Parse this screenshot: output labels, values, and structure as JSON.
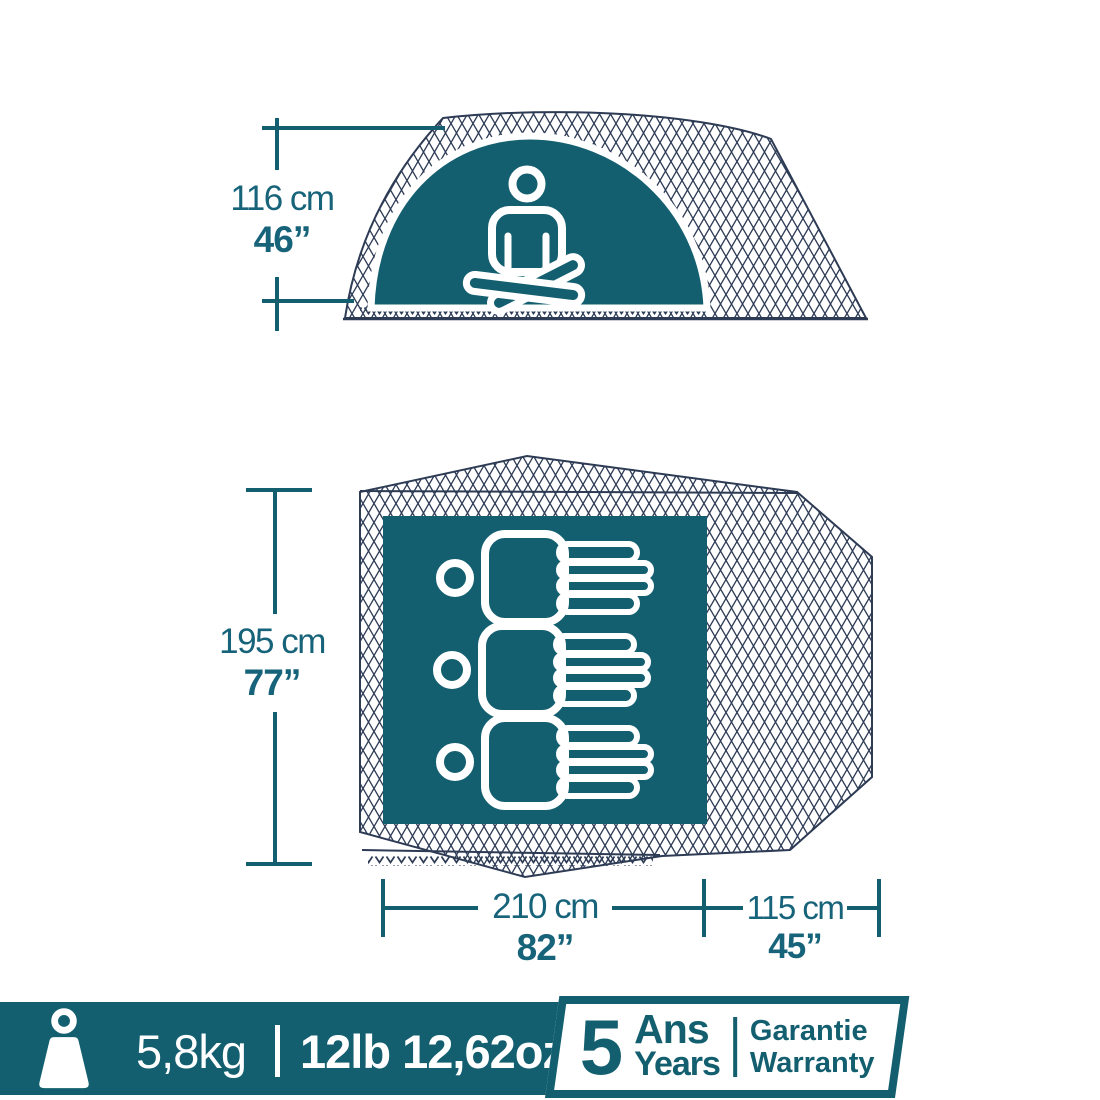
{
  "colors": {
    "teal": "#135F6F",
    "teal-text": "#17637A",
    "navy": "#2D3B55",
    "white": "#FFFFFF"
  },
  "side_view": {
    "description": "tent side profile with seated person",
    "height_cm": "116 cm",
    "height_in": "46”"
  },
  "floor_plan": {
    "description": "tent footprint with 3 sleeping places",
    "capacity_persons": 3,
    "depth_cm": "195 cm",
    "depth_in": "77”",
    "bedroom_width_cm": "210 cm",
    "bedroom_width_in": "82”",
    "vestibule_width_cm": "115 cm",
    "vestibule_width_in": "45”"
  },
  "footer": {
    "weight_metric": "5,8kg",
    "separator": "|",
    "weight_imperial": "12lb 12,62oz",
    "warranty": {
      "number": "5",
      "unit_fr": "Ans",
      "unit_en": "Years",
      "label_fr": "Garantie",
      "label_en": "Warranty"
    }
  },
  "icons": {
    "weight": "weight-icon",
    "seated_person": "meditating-person-icon",
    "lying_person": "lying-person-icon"
  }
}
